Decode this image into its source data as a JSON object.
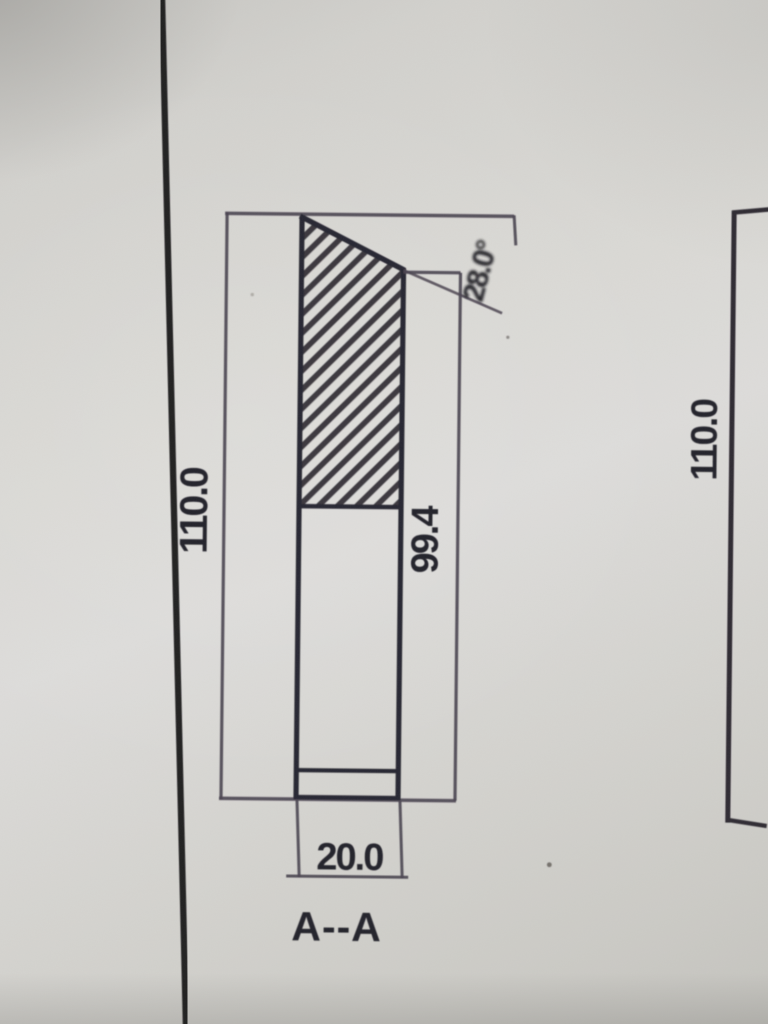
{
  "main_view": {
    "section_label": "A--A",
    "height_label": "110.0",
    "inner_height_label": "99.4",
    "width_label": "20.0",
    "angle_label": "28.0°"
  },
  "right_view": {
    "height_label": "110.0"
  },
  "colors": {
    "paper": "#d8d7d3",
    "dim_line": "#4a4450",
    "part_outline": "#282530",
    "ink_text": "#23202a"
  }
}
